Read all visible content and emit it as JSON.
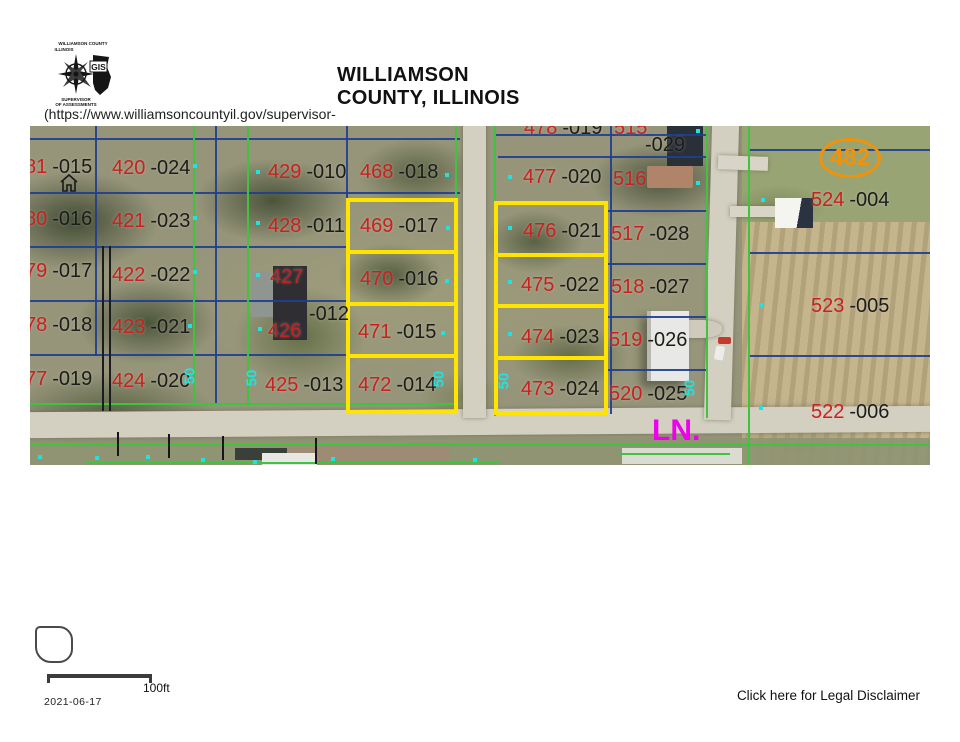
{
  "header": {
    "logo": {
      "top_text1": "WILLIAMSON COUNTY",
      "top_text2": "ILLINOIS",
      "gis": "GIS",
      "bottom_text1": "SUPERVISOR",
      "bottom_text2": "OF ASSESSMENTS"
    },
    "title_line1": "WILLIAMSON",
    "title_line2": "COUNTY, ILLINOIS",
    "url": "(https://www.williamsoncountyil.gov/supervisor-"
  },
  "map": {
    "street_label": "LN.",
    "circled_parcel": "482",
    "colors": {
      "parcel_red": "#cc1f1f",
      "lot_black": "#1c1c1c",
      "highlight_yellow": "#ffe400",
      "line_green": "#3ec43e",
      "line_blue": "#1f3f8f",
      "dot_cyan": "#1fe2e2",
      "street_magenta": "#ee00ee",
      "circle_orange": "#f0920a"
    },
    "parcel_labels": [
      {
        "red": "81",
        "black": "-015",
        "x": -5,
        "y": 30
      },
      {
        "red": "420",
        "black": "-024",
        "x": 82,
        "y": 31
      },
      {
        "red": "80",
        "black": "-016",
        "x": -5,
        "y": 82
      },
      {
        "red": "421",
        "black": "-023",
        "x": 82,
        "y": 84
      },
      {
        "red": "79",
        "black": "-017",
        "x": -5,
        "y": 134
      },
      {
        "red": "422",
        "black": "-022",
        "x": 82,
        "y": 138
      },
      {
        "red": "78",
        "black": "-018",
        "x": -5,
        "y": 188
      },
      {
        "red": "423",
        "black": "-021",
        "x": 82,
        "y": 190
      },
      {
        "red": "77",
        "black": "-019",
        "x": -5,
        "y": 242
      },
      {
        "red": "424",
        "black": "-020",
        "x": 82,
        "y": 244
      },
      {
        "red": "429",
        "black": "-010",
        "x": 238,
        "y": 35
      },
      {
        "red": "468",
        "black": "-018",
        "x": 330,
        "y": 35
      },
      {
        "red": "428",
        "black": "-011",
        "x": 238,
        "y": 89
      },
      {
        "red": "469",
        "black": "-017",
        "x": 330,
        "y": 89
      },
      {
        "red": "427",
        "black": "",
        "x": 240,
        "y": 140
      },
      {
        "red": "470",
        "black": "-016",
        "x": 330,
        "y": 142
      },
      {
        "red": "",
        "black": "-012",
        "x": 274,
        "y": 177
      },
      {
        "red": "426",
        "black": "",
        "x": 238,
        "y": 194
      },
      {
        "red": "471",
        "black": "-015",
        "x": 328,
        "y": 195
      },
      {
        "red": "425",
        "black": "-013",
        "x": 235,
        "y": 248
      },
      {
        "red": "472",
        "black": "-014",
        "x": 328,
        "y": 248
      },
      {
        "red": "478",
        "black": "-019",
        "x": 494,
        "y": -9
      },
      {
        "red": "515",
        "black": "",
        "x": 584,
        "y": -9
      },
      {
        "red": "",
        "black": "-029",
        "x": 610,
        "y": 8
      },
      {
        "red": "477",
        "black": "-020",
        "x": 493,
        "y": 40
      },
      {
        "red": "516",
        "black": "",
        "x": 583,
        "y": 42
      },
      {
        "red": "476",
        "black": "-021",
        "x": 493,
        "y": 94
      },
      {
        "red": "517",
        "black": "-028",
        "x": 581,
        "y": 97
      },
      {
        "red": "475",
        "black": "-022",
        "x": 491,
        "y": 148
      },
      {
        "red": "518",
        "black": "-027",
        "x": 581,
        "y": 150
      },
      {
        "red": "474",
        "black": "-023",
        "x": 491,
        "y": 200
      },
      {
        "red": "519",
        "black": "-026",
        "x": 579,
        "y": 203
      },
      {
        "red": "473",
        "black": "-024",
        "x": 491,
        "y": 252
      },
      {
        "red": "520",
        "black": "-025",
        "x": 579,
        "y": 257
      },
      {
        "red": "524",
        "black": "-004",
        "x": 781,
        "y": 63
      },
      {
        "red": "523",
        "black": "-005",
        "x": 781,
        "y": 169
      },
      {
        "red": "522",
        "black": "-006",
        "x": 781,
        "y": 275
      }
    ],
    "width_labels": [
      {
        "text": "50",
        "x": 160,
        "y": 250
      },
      {
        "text": "50",
        "x": 222,
        "y": 252
      },
      {
        "text": "50",
        "x": 409,
        "y": 253
      },
      {
        "text": "50",
        "x": 474,
        "y": 255
      },
      {
        "text": "50",
        "x": 660,
        "y": 262
      }
    ],
    "dots": [
      {
        "x": 163,
        "y": 38
      },
      {
        "x": 163,
        "y": 90
      },
      {
        "x": 163,
        "y": 144
      },
      {
        "x": 158,
        "y": 198
      },
      {
        "x": 226,
        "y": 44
      },
      {
        "x": 226,
        "y": 95
      },
      {
        "x": 226,
        "y": 147
      },
      {
        "x": 228,
        "y": 201
      },
      {
        "x": 415,
        "y": 47
      },
      {
        "x": 416,
        "y": 100
      },
      {
        "x": 415,
        "y": 153
      },
      {
        "x": 411,
        "y": 205
      },
      {
        "x": 478,
        "y": 49
      },
      {
        "x": 478,
        "y": 100
      },
      {
        "x": 478,
        "y": 154
      },
      {
        "x": 478,
        "y": 206
      },
      {
        "x": 666,
        "y": 3
      },
      {
        "x": 666,
        "y": 55
      },
      {
        "x": 731,
        "y": 72
      },
      {
        "x": 729,
        "y": 177
      },
      {
        "x": 729,
        "y": 280
      },
      {
        "x": 8,
        "y": 329
      },
      {
        "x": 65,
        "y": 330
      },
      {
        "x": 116,
        "y": 329
      },
      {
        "x": 171,
        "y": 332
      },
      {
        "x": 223,
        "y": 334
      },
      {
        "x": 301,
        "y": 331
      },
      {
        "x": 443,
        "y": 332
      }
    ]
  },
  "footer": {
    "scale_label": "100ft",
    "date": "2021-06-17",
    "disclaimer": "Click here for Legal Disclaimer"
  }
}
